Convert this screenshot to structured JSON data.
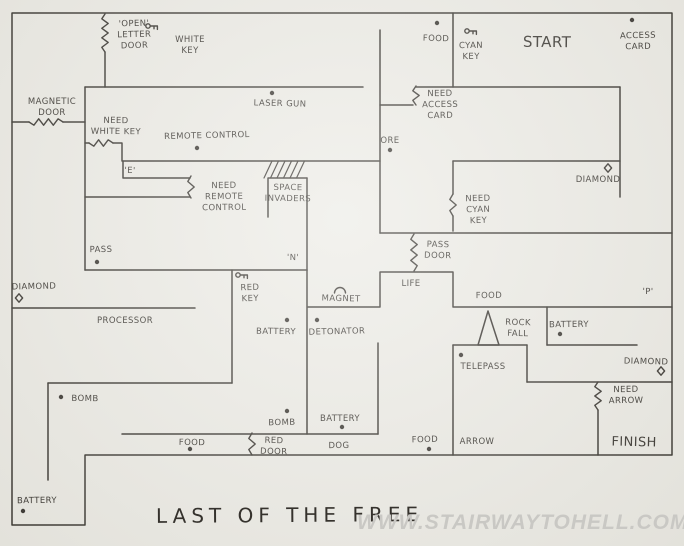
{
  "map": {
    "title": "LAST OF THE FREE",
    "watermark": "WWW.STAIRWAYTOHELL.COM",
    "colors": {
      "paper": "#ecebe5",
      "ink": "#35322d",
      "watermark": "#c9c8c4"
    },
    "walls": [
      {
        "name": "outer-boundary",
        "points": [
          [
            12,
            13
          ],
          [
            672,
            13
          ],
          [
            672,
            455
          ],
          [
            85,
            455
          ],
          [
            85,
            525
          ],
          [
            12,
            525
          ],
          [
            12,
            13
          ]
        ]
      },
      {
        "name": "wall-letter-door-lower",
        "points": [
          [
            105,
            52
          ],
          [
            105,
            87
          ]
        ]
      },
      {
        "name": "wall-top-room-south-left",
        "points": [
          [
            85,
            87
          ],
          [
            363,
            87
          ]
        ]
      },
      {
        "name": "wall-pass-room-west",
        "points": [
          [
            85,
            87
          ],
          [
            85,
            270
          ]
        ]
      },
      {
        "name": "wall-magnetic-left",
        "points": [
          [
            12,
            122
          ],
          [
            29,
            122
          ]
        ]
      },
      {
        "name": "wall-magnetic-right",
        "points": [
          [
            63,
            122
          ],
          [
            85,
            122
          ]
        ]
      },
      {
        "name": "wall-whitekey-stub",
        "points": [
          [
            85,
            143
          ],
          [
            89,
            143
          ]
        ]
      },
      {
        "name": "wall-remote-room-north",
        "points": [
          [
            113,
            143
          ],
          [
            122,
            143
          ],
          [
            122,
            161
          ],
          [
            380,
            161
          ]
        ]
      },
      {
        "name": "wall-e-corridor-north",
        "points": [
          [
            123,
            161
          ],
          [
            123,
            178
          ],
          [
            190,
            178
          ]
        ]
      },
      {
        "name": "wall-e-corridor-south",
        "points": [
          [
            85,
            197
          ],
          [
            190,
            197
          ]
        ]
      },
      {
        "name": "wall-pass-room-south",
        "points": [
          [
            85,
            270
          ],
          [
            307,
            270
          ]
        ]
      },
      {
        "name": "wall-space-invaders-box",
        "points": [
          [
            268,
            217
          ],
          [
            268,
            178
          ],
          [
            307,
            178
          ]
        ]
      },
      {
        "name": "wall-x307-upper",
        "points": [
          [
            307,
            178
          ],
          [
            307,
            270
          ]
        ]
      },
      {
        "name": "wall-x380",
        "points": [
          [
            380,
            30
          ],
          [
            380,
            233
          ]
        ]
      },
      {
        "name": "wall-access-step",
        "points": [
          [
            380,
            105
          ],
          [
            413,
            105
          ]
        ]
      },
      {
        "name": "wall-top-room-south-right",
        "points": [
          [
            416,
            87
          ],
          [
            620,
            87
          ]
        ]
      },
      {
        "name": "wall-start-room-west",
        "points": [
          [
            453,
            13
          ],
          [
            453,
            87
          ]
        ]
      },
      {
        "name": "wall-x620",
        "points": [
          [
            620,
            87
          ],
          [
            620,
            197
          ]
        ]
      },
      {
        "name": "wall-diamond-room-north",
        "points": [
          [
            453,
            161
          ],
          [
            620,
            161
          ]
        ]
      },
      {
        "name": "wall-cyan-upper",
        "points": [
          [
            453,
            161
          ],
          [
            453,
            194
          ]
        ]
      },
      {
        "name": "wall-cyan-lower",
        "points": [
          [
            453,
            216
          ],
          [
            453,
            231
          ]
        ]
      },
      {
        "name": "wall-corridor-north",
        "points": [
          [
            380,
            233
          ],
          [
            672,
            233
          ]
        ]
      },
      {
        "name": "wall-life-notch",
        "points": [
          [
            308,
            307
          ],
          [
            380,
            307
          ],
          [
            380,
            272
          ],
          [
            453,
            272
          ],
          [
            453,
            307
          ],
          [
            672,
            307
          ]
        ]
      },
      {
        "name": "wall-x307-lower",
        "points": [
          [
            307,
            270
          ],
          [
            307,
            434
          ]
        ]
      },
      {
        "name": "wall-x232",
        "points": [
          [
            232,
            270
          ],
          [
            232,
            383
          ]
        ]
      },
      {
        "name": "wall-processor-north",
        "points": [
          [
            12,
            308
          ],
          [
            195,
            308
          ]
        ]
      },
      {
        "name": "wall-y383",
        "points": [
          [
            48,
            383
          ],
          [
            232,
            383
          ]
        ]
      },
      {
        "name": "wall-x48",
        "points": [
          [
            48,
            383
          ],
          [
            48,
            480
          ]
        ]
      },
      {
        "name": "wall-y434",
        "points": [
          [
            122,
            434
          ],
          [
            378,
            434
          ]
        ]
      },
      {
        "name": "wall-x378-lower",
        "points": [
          [
            378,
            343
          ],
          [
            378,
            434
          ]
        ]
      },
      {
        "name": "wall-x453-lower",
        "points": [
          [
            453,
            345
          ],
          [
            453,
            455
          ]
        ]
      },
      {
        "name": "wall-y345-left",
        "points": [
          [
            453,
            345
          ],
          [
            527,
            345
          ]
        ]
      },
      {
        "name": "wall-telepass-east",
        "points": [
          [
            527,
            345
          ],
          [
            527,
            382
          ]
        ]
      },
      {
        "name": "wall-y382",
        "points": [
          [
            527,
            382
          ],
          [
            672,
            382
          ]
        ]
      },
      {
        "name": "wall-x547",
        "points": [
          [
            547,
            307
          ],
          [
            547,
            345
          ]
        ]
      },
      {
        "name": "wall-y345-right",
        "points": [
          [
            547,
            345
          ],
          [
            637,
            345
          ]
        ]
      },
      {
        "name": "wall-x598-lower",
        "points": [
          [
            598,
            410
          ],
          [
            598,
            455
          ]
        ]
      },
      {
        "name": "rockfall-triangle",
        "points": [
          [
            488,
            311
          ],
          [
            478,
            345
          ],
          [
            499,
            345
          ],
          [
            488,
            311
          ]
        ]
      }
    ],
    "doors": [
      {
        "name": "door-open-letter",
        "from": [
          105,
          14
        ],
        "to": [
          105,
          52
        ]
      },
      {
        "name": "door-magnetic",
        "from": [
          29,
          122
        ],
        "to": [
          63,
          122
        ]
      },
      {
        "name": "door-need-white-key",
        "from": [
          89,
          143
        ],
        "to": [
          113,
          143
        ]
      },
      {
        "name": "door-need-remote-control",
        "from": [
          191,
          176
        ],
        "to": [
          191,
          198
        ]
      },
      {
        "name": "door-need-access-card",
        "from": [
          416,
          86
        ],
        "to": [
          416,
          105
        ]
      },
      {
        "name": "door-need-cyan-key",
        "from": [
          453,
          194
        ],
        "to": [
          453,
          216
        ]
      },
      {
        "name": "door-pass",
        "from": [
          414,
          234
        ],
        "to": [
          414,
          271
        ]
      },
      {
        "name": "door-red",
        "from": [
          252,
          433
        ],
        "to": [
          252,
          455
        ]
      },
      {
        "name": "door-need-arrow",
        "from": [
          598,
          382
        ],
        "to": [
          598,
          410
        ]
      }
    ],
    "hatch": {
      "name": "hatch-marks",
      "x": 264,
      "y": 178,
      "count": 6,
      "dx": 6.5,
      "rise": 17,
      "run": 8
    },
    "items": [
      {
        "name": "item-food-top",
        "x": 437,
        "y": 23
      },
      {
        "name": "item-access-card",
        "x": 632,
        "y": 20
      },
      {
        "name": "item-laser-gun",
        "x": 272,
        "y": 93
      },
      {
        "name": "item-remote-control",
        "x": 197,
        "y": 148
      },
      {
        "name": "item-ore",
        "x": 390,
        "y": 150
      },
      {
        "name": "item-pass",
        "x": 97,
        "y": 262
      },
      {
        "name": "item-battery-redkey-room",
        "x": 287,
        "y": 320
      },
      {
        "name": "item-detonator",
        "x": 317,
        "y": 320
      },
      {
        "name": "item-battery-rockfall-room",
        "x": 560,
        "y": 334
      },
      {
        "name": "item-telepass",
        "x": 461,
        "y": 355
      },
      {
        "name": "item-bomb-left",
        "x": 61,
        "y": 397
      },
      {
        "name": "item-bomb-mid",
        "x": 287,
        "y": 411
      },
      {
        "name": "item-battery-mid",
        "x": 342,
        "y": 427
      },
      {
        "name": "item-food-bottom-left",
        "x": 190,
        "y": 449
      },
      {
        "name": "item-food-bottom-mid",
        "x": 429,
        "y": 449
      },
      {
        "name": "item-battery-bottom-left",
        "x": 23,
        "y": 511
      }
    ],
    "icons": [
      {
        "type": "key",
        "name": "white-key-icon",
        "x": 148,
        "y": 26
      },
      {
        "type": "key",
        "name": "cyan-key-icon",
        "x": 467,
        "y": 31
      },
      {
        "type": "key",
        "name": "red-key-icon",
        "x": 238,
        "y": 275
      },
      {
        "type": "diamond",
        "name": "diamond-mid-icon",
        "x": 608,
        "y": 168
      },
      {
        "type": "diamond",
        "name": "diamond-left-icon",
        "x": 19,
        "y": 298
      },
      {
        "type": "diamond",
        "name": "diamond-bottom-icon",
        "x": 661,
        "y": 371
      },
      {
        "type": "magnet",
        "name": "magnet-icon",
        "x": 340,
        "y": 290
      }
    ],
    "labels": [
      {
        "name": "lbl-open-letter-door",
        "x": 134,
        "y": 26,
        "lines": [
          "'OPEN'",
          "LETTER",
          "DOOR"
        ]
      },
      {
        "name": "lbl-white-key",
        "x": 190,
        "y": 42,
        "lines": [
          "WHITE",
          "KEY"
        ]
      },
      {
        "name": "lbl-food-top",
        "x": 436,
        "y": 41,
        "lines": [
          "FOOD"
        ]
      },
      {
        "name": "lbl-cyan-key",
        "x": 471,
        "y": 48,
        "lines": [
          "CYAN",
          "KEY"
        ]
      },
      {
        "name": "lbl-start",
        "x": 547,
        "y": 47,
        "size": 15,
        "lines": [
          "START"
        ]
      },
      {
        "name": "lbl-access-card",
        "x": 638,
        "y": 38,
        "lines": [
          "ACCESS",
          "CARD"
        ]
      },
      {
        "name": "lbl-magnetic-door",
        "x": 52,
        "y": 104,
        "lines": [
          "MAGNETIC",
          "DOOR"
        ]
      },
      {
        "name": "lbl-laser-gun",
        "x": 280,
        "y": 106,
        "lines": [
          "LASER GUN"
        ]
      },
      {
        "name": "lbl-need-access-card",
        "x": 440,
        "y": 96,
        "lines": [
          "NEED",
          "ACCESS",
          "CARD"
        ]
      },
      {
        "name": "lbl-need-white-key",
        "x": 116,
        "y": 123,
        "lines": [
          "NEED",
          "WHITE KEY"
        ]
      },
      {
        "name": "lbl-remote-control",
        "x": 207,
        "y": 138,
        "lines": [
          "REMOTE CONTROL"
        ]
      },
      {
        "name": "lbl-ore",
        "x": 390,
        "y": 143,
        "lines": [
          "ORE"
        ]
      },
      {
        "name": "lbl-e-pad",
        "x": 130,
        "y": 173,
        "lines": [
          "'E'"
        ]
      },
      {
        "name": "lbl-need-remote-control",
        "x": 224,
        "y": 188,
        "lines": [
          "NEED",
          "REMOTE",
          "CONTROL"
        ]
      },
      {
        "name": "lbl-space-invaders",
        "x": 288,
        "y": 190,
        "lines": [
          "SPACE",
          "INVADERS"
        ]
      },
      {
        "name": "lbl-need-cyan-key",
        "x": 478,
        "y": 201,
        "lines": [
          "NEED",
          "CYAN",
          "KEY"
        ]
      },
      {
        "name": "lbl-diamond-mid",
        "x": 598,
        "y": 182,
        "lines": [
          "DIAMOND"
        ]
      },
      {
        "name": "lbl-pass-door",
        "x": 438,
        "y": 247,
        "lines": [
          "PASS",
          "DOOR"
        ]
      },
      {
        "name": "lbl-pass",
        "x": 101,
        "y": 252,
        "lines": [
          "PASS"
        ]
      },
      {
        "name": "lbl-n-pad",
        "x": 293,
        "y": 260,
        "lines": [
          "'N'"
        ]
      },
      {
        "name": "lbl-diamond-left",
        "x": 34,
        "y": 289,
        "lines": [
          "DIAMOND"
        ]
      },
      {
        "name": "lbl-life",
        "x": 411,
        "y": 286,
        "lines": [
          "LIFE"
        ]
      },
      {
        "name": "lbl-magnet",
        "x": 341,
        "y": 301,
        "lines": [
          "MAGNET"
        ]
      },
      {
        "name": "lbl-food-p-room",
        "x": 489,
        "y": 298,
        "lines": [
          "FOOD"
        ]
      },
      {
        "name": "lbl-p-pad",
        "x": 648,
        "y": 294,
        "lines": [
          "'P'"
        ]
      },
      {
        "name": "lbl-red-key",
        "x": 250,
        "y": 290,
        "lines": [
          "RED",
          "KEY"
        ]
      },
      {
        "name": "lbl-processor",
        "x": 125,
        "y": 323,
        "lines": [
          "PROCESSOR"
        ]
      },
      {
        "name": "lbl-rock-fall",
        "x": 518,
        "y": 325,
        "lines": [
          "ROCK",
          "FALL"
        ]
      },
      {
        "name": "lbl-battery-rockfall",
        "x": 569,
        "y": 327,
        "lines": [
          "BATTERY"
        ]
      },
      {
        "name": "lbl-battery-redkey",
        "x": 276,
        "y": 334,
        "lines": [
          "BATTERY"
        ]
      },
      {
        "name": "lbl-detonator",
        "x": 337,
        "y": 334,
        "lines": [
          "DETONATOR"
        ]
      },
      {
        "name": "lbl-telepass",
        "x": 483,
        "y": 369,
        "lines": [
          "TELEPASS"
        ]
      },
      {
        "name": "lbl-diamond-bottom",
        "x": 646,
        "y": 364,
        "lines": [
          "DIAMOND"
        ]
      },
      {
        "name": "lbl-need-arrow",
        "x": 626,
        "y": 392,
        "lines": [
          "NEED",
          "ARROW"
        ]
      },
      {
        "name": "lbl-bomb-left",
        "x": 85,
        "y": 401,
        "lines": [
          "BOMB"
        ]
      },
      {
        "name": "lbl-bomb-mid",
        "x": 282,
        "y": 425,
        "lines": [
          "BOMB"
        ]
      },
      {
        "name": "lbl-battery-mid",
        "x": 340,
        "y": 421,
        "lines": [
          "BATTERY"
        ]
      },
      {
        "name": "lbl-red-door",
        "x": 274,
        "y": 443,
        "lines": [
          "RED",
          "DOOR"
        ]
      },
      {
        "name": "lbl-dog",
        "x": 339,
        "y": 448,
        "lines": [
          "DOG"
        ]
      },
      {
        "name": "lbl-food-bottom-left",
        "x": 192,
        "y": 445,
        "lines": [
          "FOOD"
        ]
      },
      {
        "name": "lbl-food-bottom-mid",
        "x": 425,
        "y": 442,
        "lines": [
          "FOOD"
        ]
      },
      {
        "name": "lbl-arrow",
        "x": 477,
        "y": 444,
        "lines": [
          "ARROW"
        ]
      },
      {
        "name": "lbl-finish",
        "x": 634,
        "y": 446,
        "size": 13,
        "lines": [
          "FINISH"
        ]
      },
      {
        "name": "lbl-battery-bottom-left",
        "x": 37,
        "y": 503,
        "lines": [
          "BATTERY"
        ]
      }
    ]
  }
}
